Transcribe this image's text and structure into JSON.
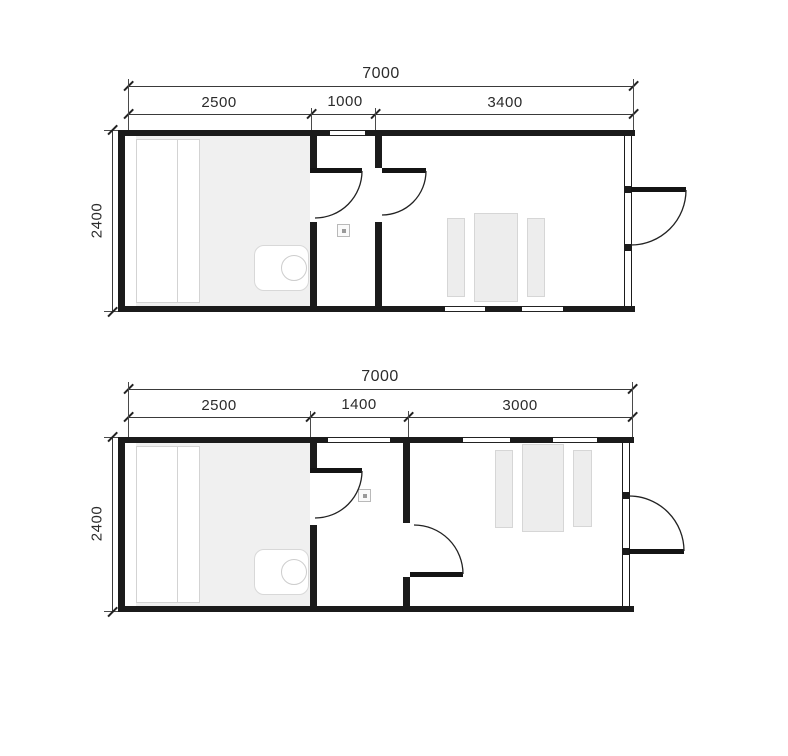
{
  "diagram": {
    "title": "container-cabin-floor-plans",
    "plans": [
      {
        "id": "upper",
        "total_width_label": "7000",
        "height_label": "2400",
        "segment_labels": [
          "2500",
          "1000",
          "3400"
        ]
      },
      {
        "id": "lower",
        "total_width_label": "7000",
        "height_label": "2400",
        "segment_labels": [
          "2500",
          "1400",
          "3000"
        ]
      }
    ],
    "colors": {
      "background": "#ffffff",
      "wall": "#1b1b1b",
      "dimension_line": "#3a3a3a",
      "text": "#2b2b2b",
      "floor_shading": "#f0f0f0",
      "furniture_fill": "#ededed",
      "furniture_border": "#d6d6d6"
    }
  }
}
